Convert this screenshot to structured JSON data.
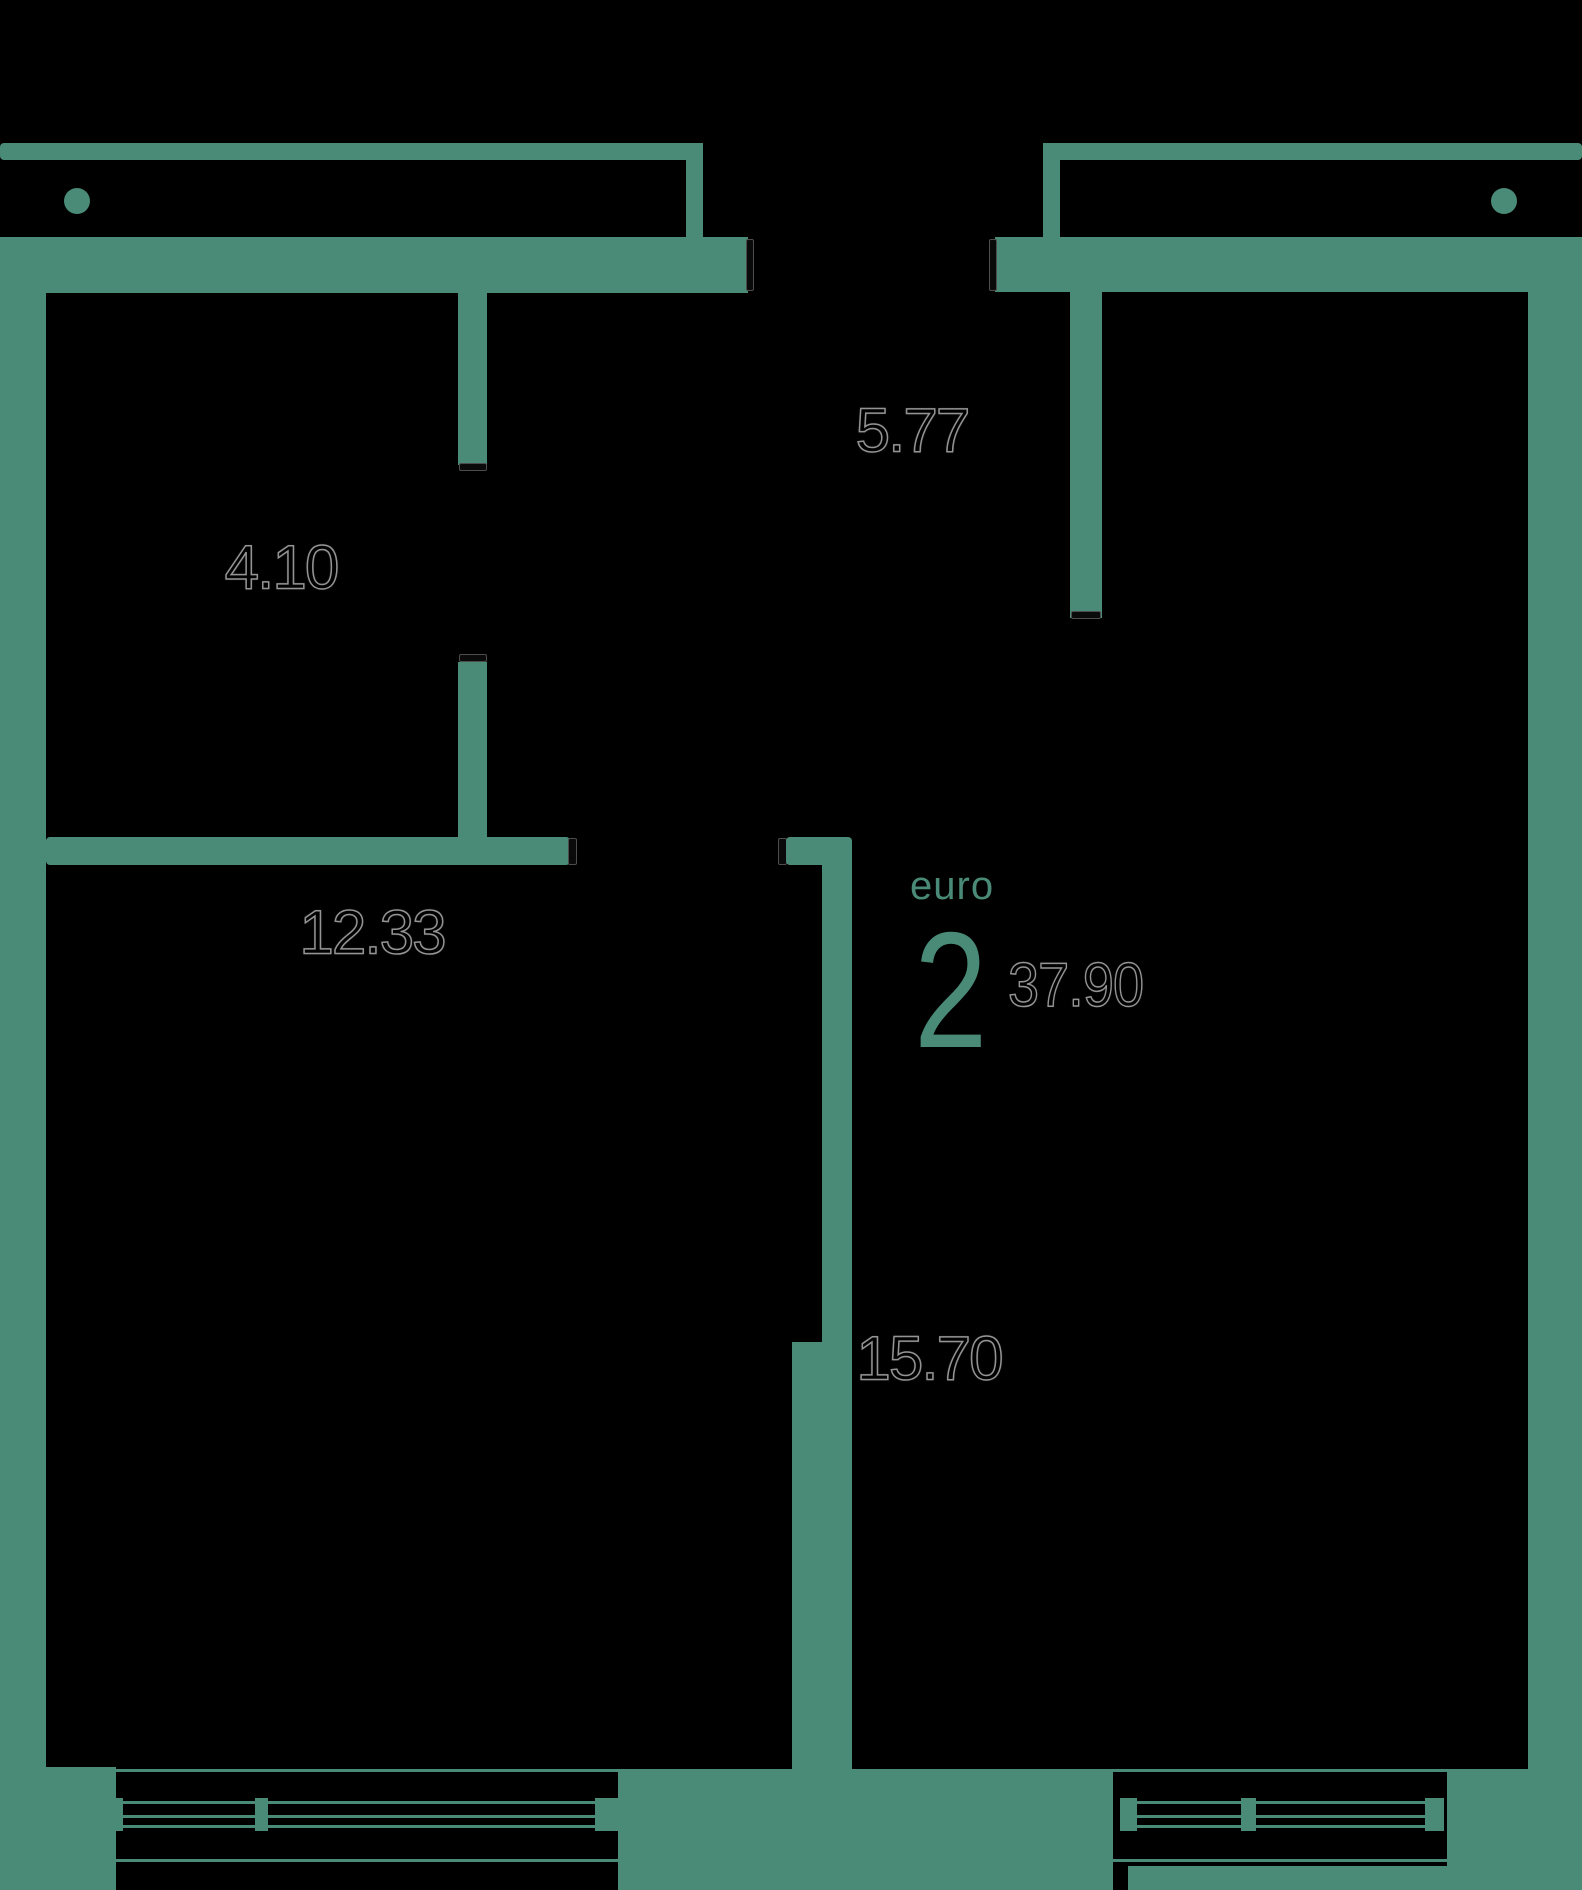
{
  "plan": {
    "unit_type_label": "euro",
    "unit_rooms_count": "2",
    "unit_total_area": "37.90",
    "rooms": [
      {
        "name": "top-left-room",
        "area": "4.10"
      },
      {
        "name": "hallway",
        "area": "5.77"
      },
      {
        "name": "bottom-left-room",
        "area": "12.33"
      },
      {
        "name": "right-room",
        "area": "15.70"
      }
    ]
  },
  "colors": {
    "wall": "#4A8B77",
    "bg": "#000000",
    "jamb-fill": "#0a0a0a",
    "jamb-line": "#4d4d4d",
    "label-fill": "#000000",
    "label-outline": "#949494"
  }
}
